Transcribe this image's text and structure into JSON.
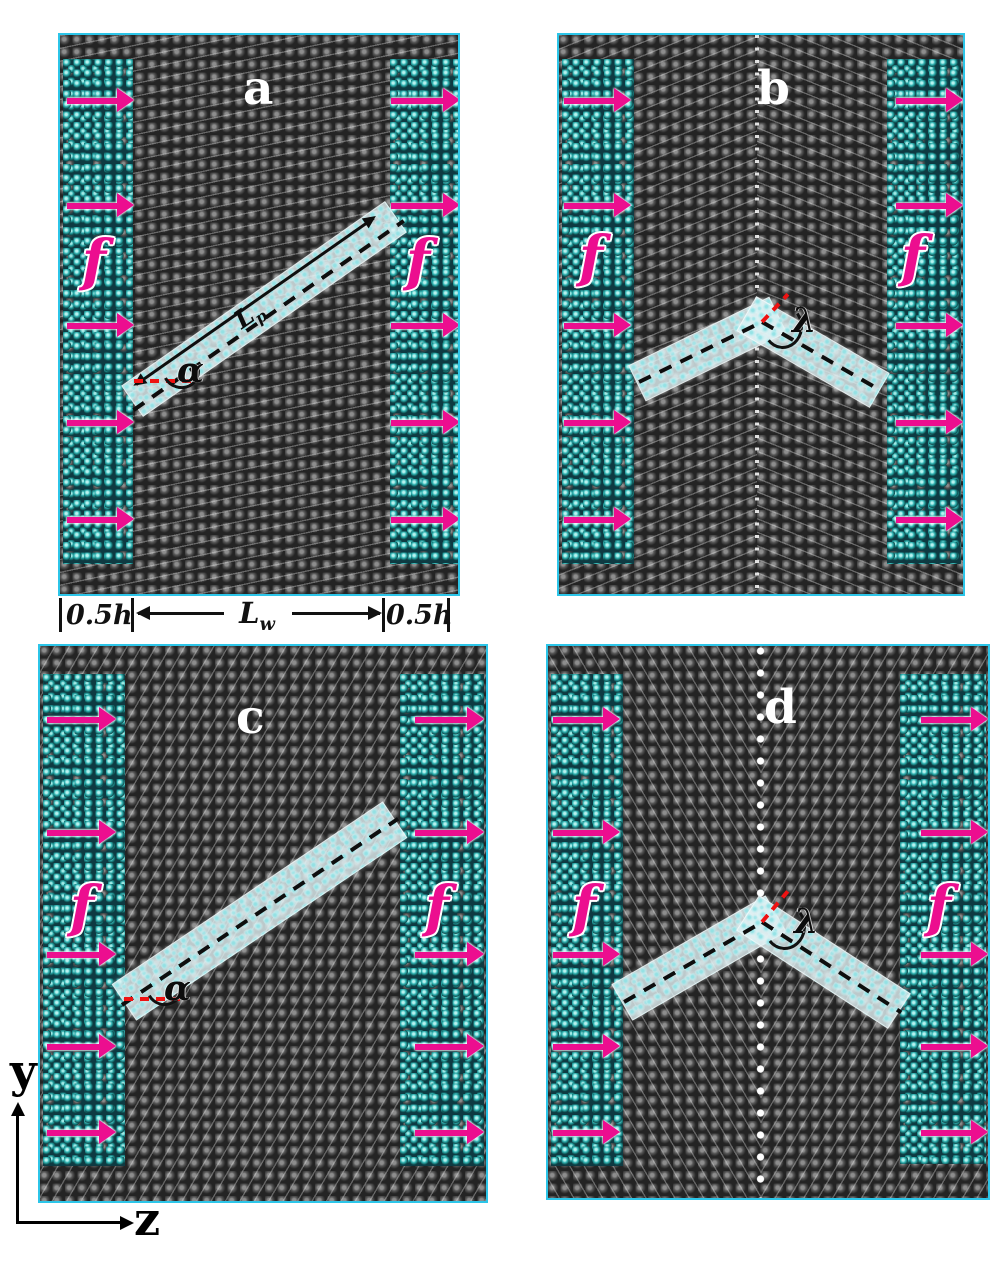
{
  "panels": [
    {
      "id": "a",
      "label": "a",
      "force_label": "f",
      "angle_label": "α",
      "pore_length_label": {
        "base": "L",
        "sub": "p"
      }
    },
    {
      "id": "b",
      "label": "b",
      "force_label": "f",
      "angle_label": "λ"
    },
    {
      "id": "c",
      "label": "c",
      "force_label": "f",
      "angle_label": "α"
    },
    {
      "id": "d",
      "label": "d",
      "force_label": "f",
      "angle_label": "λ"
    }
  ],
  "scale_bar": {
    "left_segment": "0.5h",
    "middle_label": {
      "base": "L",
      "sub": "w"
    },
    "right_segment": "0.5h"
  },
  "axes": {
    "vertical_label": "y",
    "horizontal_label": "z"
  },
  "colors": {
    "panel_border": "#2cc5e8",
    "force_arrow": "#ec0e8f",
    "membrane": "#3a3a3a",
    "water": "#1fa0a0",
    "pore_fill": "#e2f2f5",
    "angle_reference_line": "#ee1212",
    "annotation_line": "#0e0e0e",
    "panel_label_text": "#ffffff",
    "background": "#ffffff"
  }
}
